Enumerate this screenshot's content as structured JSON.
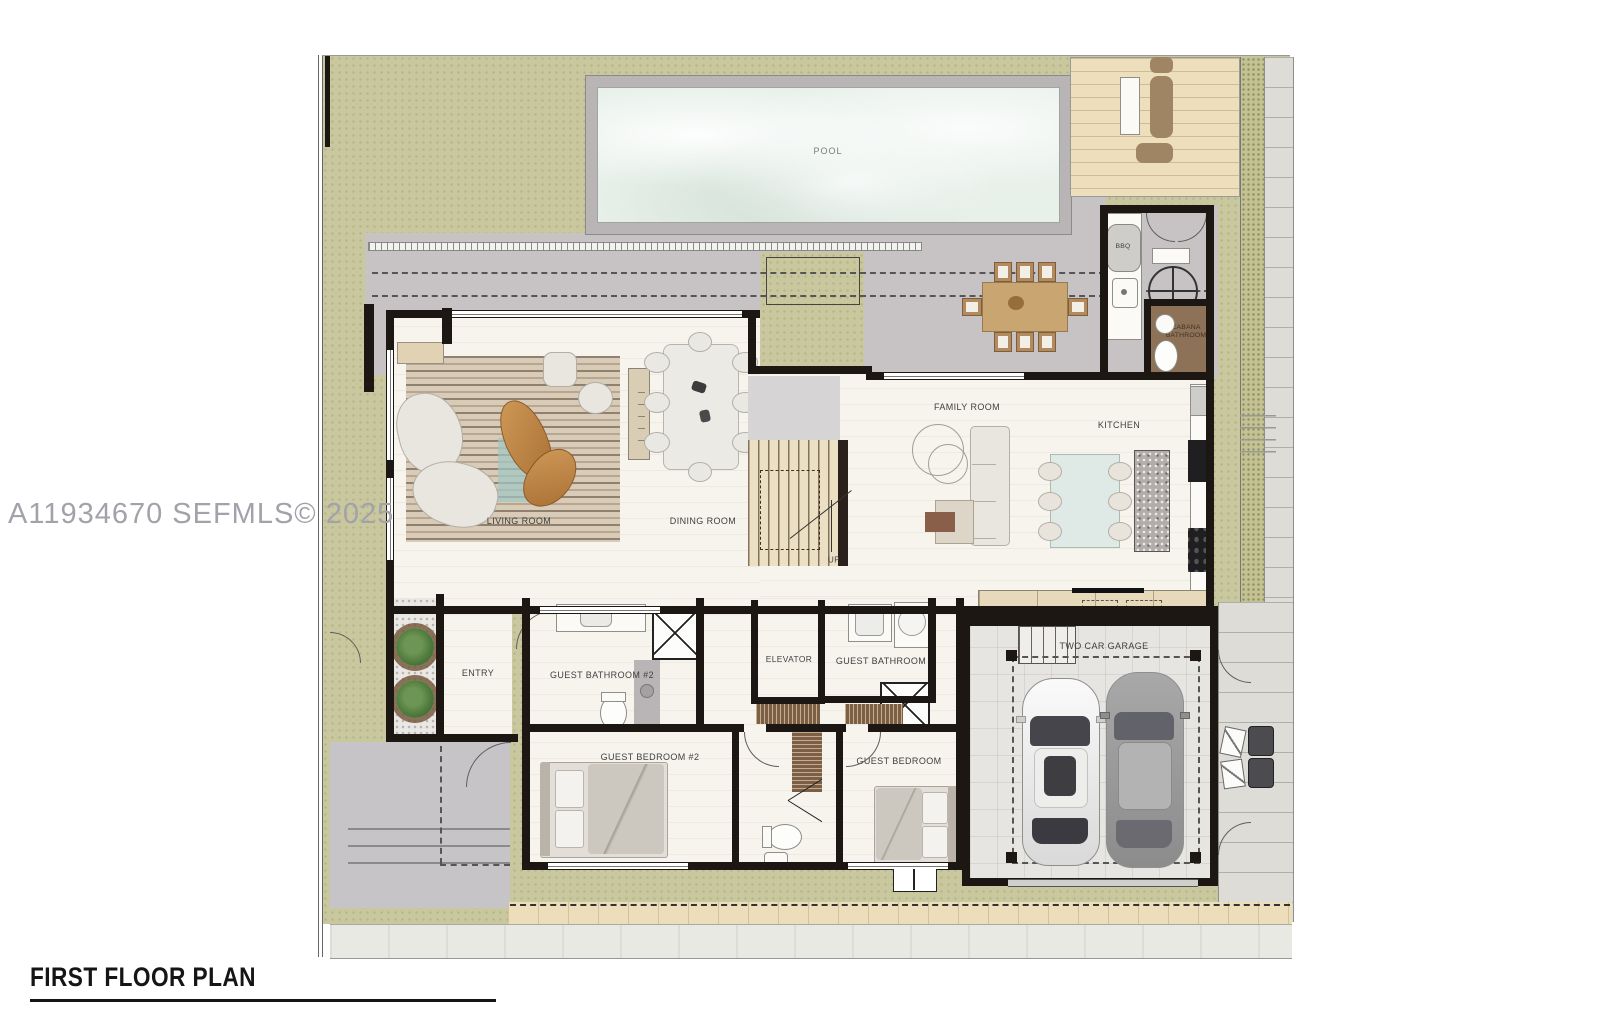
{
  "watermark": "A11934670  SEFMLS© 2025",
  "plan": {
    "title": "FIRST FLOOR PLAN",
    "rooms": {
      "pool": "POOL",
      "living_room": "LIVING ROOM",
      "dining_room": "DINING ROOM",
      "family_room": "FAMILY ROOM",
      "kitchen": "KITCHEN",
      "entry": "ENTRY",
      "elevator": "ELEVATOR",
      "guest_bathroom_2": "GUEST BATHROOM #2",
      "guest_bathroom": "GUEST BATHROOM",
      "guest_bedroom_2": "GUEST BEDROOM #2",
      "guest_bedroom": "GUEST BEDROOM",
      "cabana_bathroom": "CABANA BATHROOM",
      "garage": "TWO CAR GARAGE",
      "bbq": "BBQ",
      "stairs_up": "UP"
    },
    "colors": {
      "grass": "#c9c79e",
      "pool_water": "#e8f0ea",
      "patio": "#c7c3c5",
      "wood_deck": "#eedfbc",
      "interior_floor": "#f7f4ee",
      "wall": "#1c1712",
      "cabana_floor": "#8d7258",
      "closet_wood": "#7d5f45"
    }
  }
}
